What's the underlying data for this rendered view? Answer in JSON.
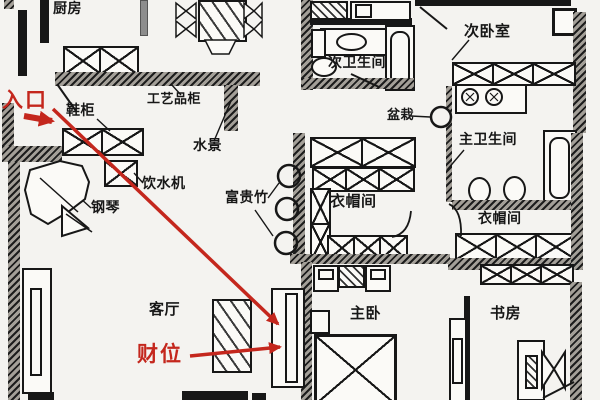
{
  "colors": {
    "annotation_red": "#c4271d",
    "ink": "#171717",
    "paper": "#f4f3f0"
  },
  "rooms": {
    "kitchen": "厨房",
    "second_bedroom": "次卧室",
    "second_bathroom": "次卫生间",
    "master_bathroom": "主卫生间",
    "cloakroom_center": "衣帽间",
    "cloakroom_right": "衣帽间",
    "living_room": "客厅",
    "master_bedroom": "主卧",
    "study": "书房"
  },
  "furniture": {
    "shoe_cabinet": "鞋柜",
    "craft_cabinet": "工艺品柜",
    "water_feature": "水景",
    "water_dispenser": "饮水机",
    "piano": "钢琴",
    "lucky_bamboo": "富贵竹",
    "potted_plant": "盆栽"
  },
  "annotations": {
    "entrance": "入口",
    "wealth_position": "财位"
  }
}
